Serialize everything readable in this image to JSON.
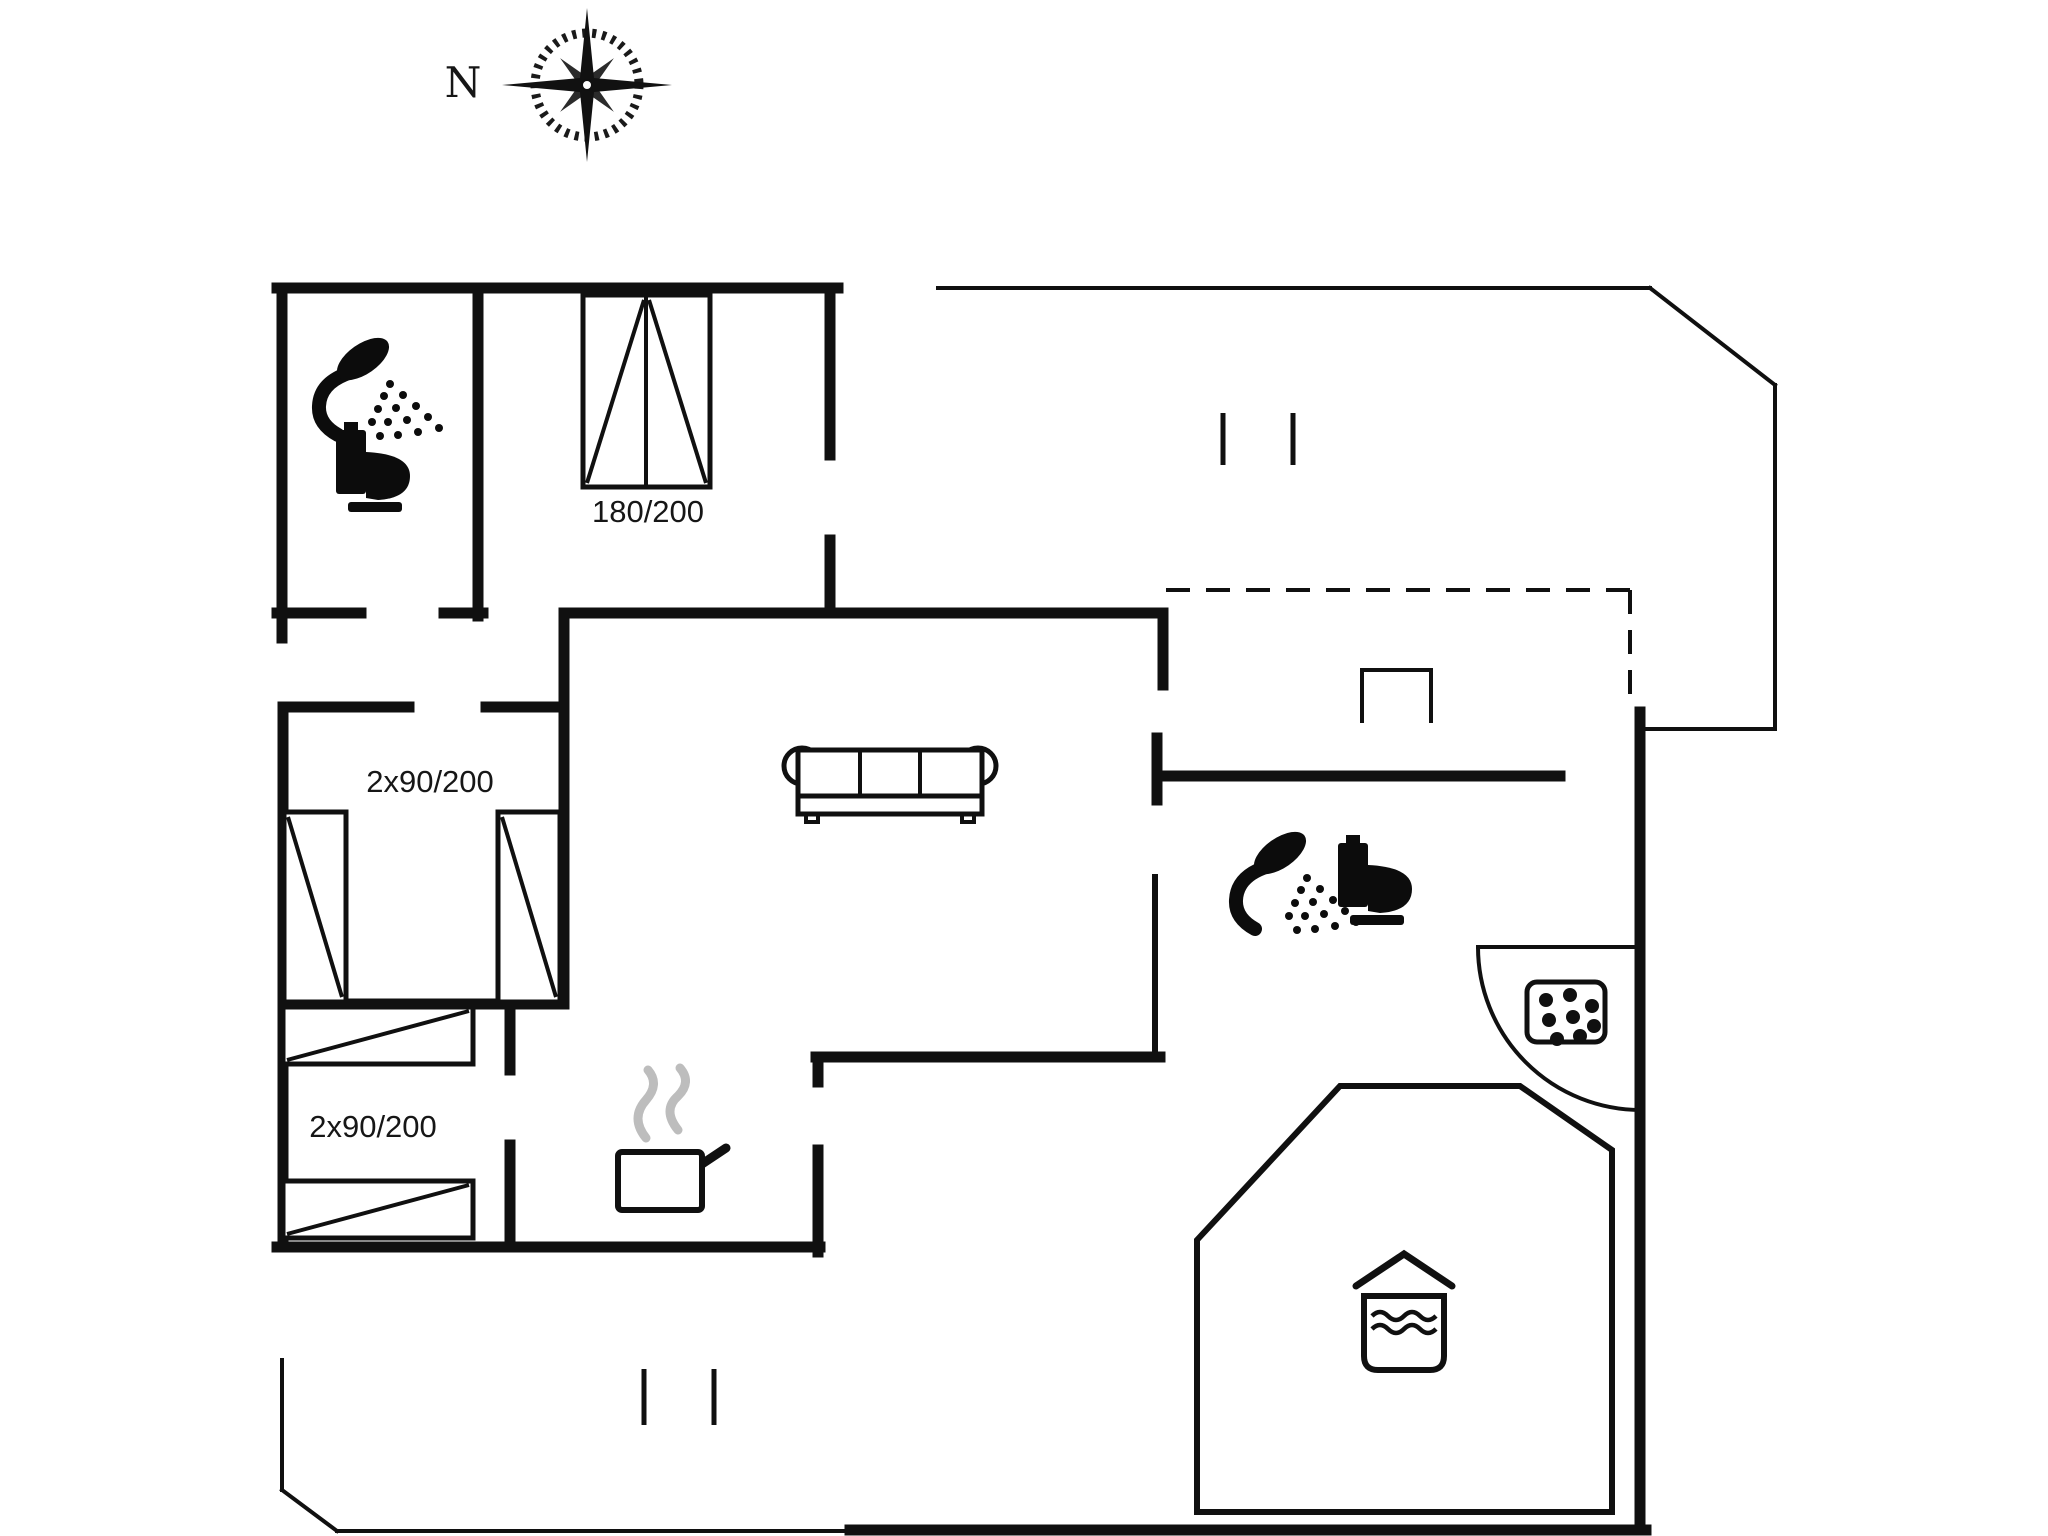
{
  "canvas": {
    "background": "#ffffff",
    "wall_color": "#101010",
    "steam_color": "#bdbdbd",
    "text_color": "#161616"
  },
  "compass": {
    "label": "N"
  },
  "bed_labels": {
    "double": "180/200",
    "twin_upper": "2x90/200",
    "twin_lower": "2x90/200"
  },
  "icons": [
    {
      "name": "compass-rose",
      "depicts": "eight-point star with serrated ring, north marker"
    },
    {
      "name": "shower-icon",
      "depicts": "handheld shower head with spray dots (2 bathrooms)"
    },
    {
      "name": "toilet-icon",
      "depicts": "toilet silhouette side view (2 bathrooms)"
    },
    {
      "name": "double-bed-icon",
      "depicts": "180/200 double bed with fold triangles"
    },
    {
      "name": "single-bed-icon",
      "depicts": "90/200 single bed with diagonal (4 total)"
    },
    {
      "name": "sofa-icon",
      "depicts": "three-seat sofa top view"
    },
    {
      "name": "cooking-pot-icon",
      "depicts": "pot with handle and rising steam (kitchen)"
    },
    {
      "name": "hob-icon",
      "depicts": "rounded box with stone dots"
    },
    {
      "name": "hot-tub-icon",
      "depicts": "roofed box with water waves (spa room)"
    },
    {
      "name": "window-marker",
      "depicts": "pairs of short parallel ticks"
    },
    {
      "name": "door-arc-icon",
      "depicts": "quarter-circle swing arc"
    },
    {
      "name": "dashed-boundary",
      "depicts": "dashed open-plan boundary line"
    },
    {
      "name": "wardrobe-icon",
      "depicts": "small open rectangle on wall"
    }
  ]
}
